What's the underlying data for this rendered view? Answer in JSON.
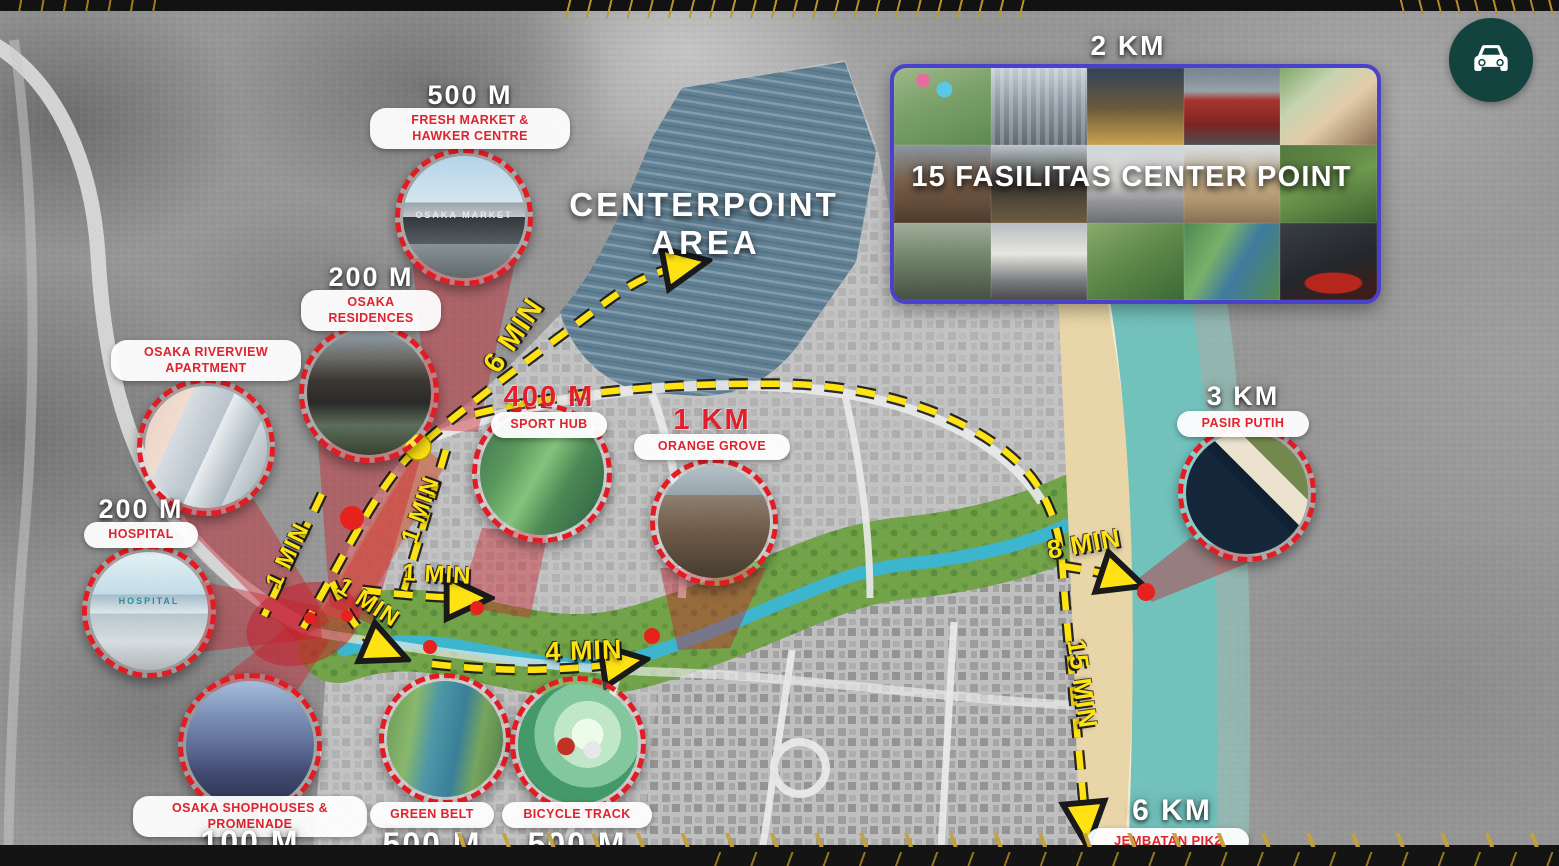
{
  "panel": {
    "distance": "2 KM",
    "title": "15 FASILITAS CENTER POINT"
  },
  "centerpoint": {
    "line1": "CENTERPOINT",
    "line2": "AREA"
  },
  "callouts": [
    {
      "id": "fresh-market",
      "distance": "500 M",
      "name": "FRESH MARKET & HAWKER CENTRE",
      "photo_text": "OSAKA MARKET"
    },
    {
      "id": "osaka-residences",
      "distance": "200 M",
      "name": "OSAKA RESIDENCES"
    },
    {
      "id": "osaka-riverview-apartment",
      "name": "OSAKA RIVERVIEW APARTMENT"
    },
    {
      "id": "hospital",
      "distance": "200 M",
      "name": "HOSPITAL",
      "photo_text": "HOSPITAL"
    },
    {
      "id": "sport-hub",
      "distance": "400 M",
      "name": "SPORT HUB"
    },
    {
      "id": "orange-grove",
      "distance": "1 KM",
      "name": "ORANGE GROVE"
    },
    {
      "id": "pasir-putih",
      "distance": "3 KM",
      "name": "PASIR PUTIH"
    },
    {
      "id": "osaka-shophouses",
      "name": "OSAKA SHOPHOUSES & PROMENADE",
      "distance": "100 M"
    },
    {
      "id": "green-belt",
      "name": "GREEN BELT",
      "distance": "500 M"
    },
    {
      "id": "bicycle-track",
      "name": "BICYCLE TRACK",
      "distance": "500 M"
    },
    {
      "id": "jembatan-pik2",
      "distance": "6 KM",
      "name": "JEMBATAN PIK2"
    }
  ],
  "route_labels": [
    {
      "text": "6 MIN"
    },
    {
      "text": "1 MIN"
    },
    {
      "text": "1 MIN"
    },
    {
      "text": "1 MIN"
    },
    {
      "text": "1 MIN"
    },
    {
      "text": "4 MIN"
    },
    {
      "text": "8 MIN"
    },
    {
      "text": "15 MIN"
    }
  ],
  "colors": {
    "route_yellow": "#ffe312",
    "marker_red": "#e31c24",
    "panel_border": "#4a41cc",
    "car_badge_teal": "#12433f",
    "centerpoint_blue": "#54788e"
  },
  "icons": {
    "car": "car-icon"
  }
}
